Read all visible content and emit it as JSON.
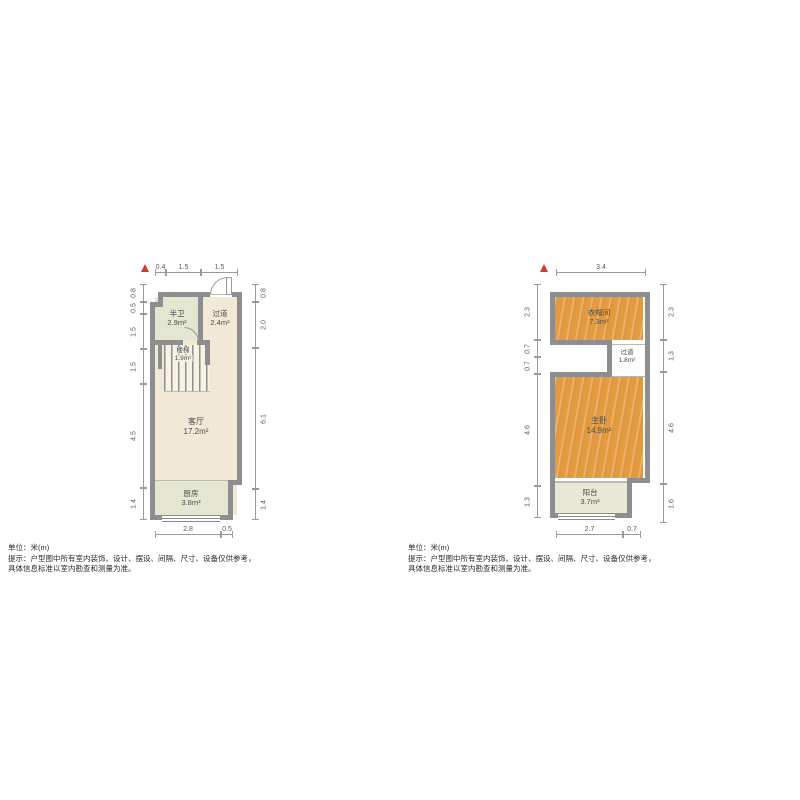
{
  "colors": {
    "wall": "#8e8e8e",
    "thin": "#b9b9ad",
    "dim": "#9a9a9a",
    "dimtext": "#5a5a5a",
    "win": "#8a8a8a",
    "floor_beige": "#f1e8d5",
    "floor_sage": "#e4e6d0",
    "floor_wood": "#e49b3f",
    "floor_balcony": "#e8e8d5",
    "north": "#cf3a30",
    "text": "#4d4d4d",
    "disc": "#2b2b2b"
  },
  "disclaimer": {
    "unit": "单位：米(m)",
    "line1": "提示：户型图中所有室内装饰、设计、摆设、间隔、尺寸、设备仅供参考，",
    "line2": "具体信息标准以室内勘查和测量为准。"
  },
  "floor1": {
    "rooms": {
      "half_bath": {
        "label": "半卫",
        "area": "2.9m²"
      },
      "hallway": {
        "label": "过道",
        "area": "2.4m²"
      },
      "stairs": {
        "label": "楼梯",
        "area": "1.9m²"
      },
      "living": {
        "label": "客厅",
        "area": "17.2m²"
      },
      "kitchen": {
        "label": "厨房",
        "area": "3.8m²"
      }
    },
    "dims": {
      "top": [
        "0.4",
        "1.5",
        "1.5"
      ],
      "left": [
        "0.8",
        "0.5",
        "1.5",
        "1.5",
        "4.5",
        "1.4"
      ],
      "right": [
        "0.8",
        "2.0",
        "6.1",
        "1.4"
      ],
      "bottom": [
        "2.8",
        "0.5"
      ]
    }
  },
  "floor2": {
    "rooms": {
      "cloakroom": {
        "label": "衣帽间",
        "area": "7.3m²"
      },
      "hallway": {
        "label": "过道",
        "area": "1.8m²"
      },
      "master": {
        "label": "主卧",
        "area": "14.9m²"
      },
      "balcony": {
        "label": "阳台",
        "area": "3.7m²"
      }
    },
    "dims": {
      "top": [
        "3.4"
      ],
      "left": [
        "2.3",
        "0.7",
        "0.7",
        "4.6",
        "1.3"
      ],
      "right": [
        "2.3",
        "1.3",
        "4.6",
        "1.6"
      ],
      "bottom": [
        "2.7",
        "0.7"
      ]
    }
  }
}
